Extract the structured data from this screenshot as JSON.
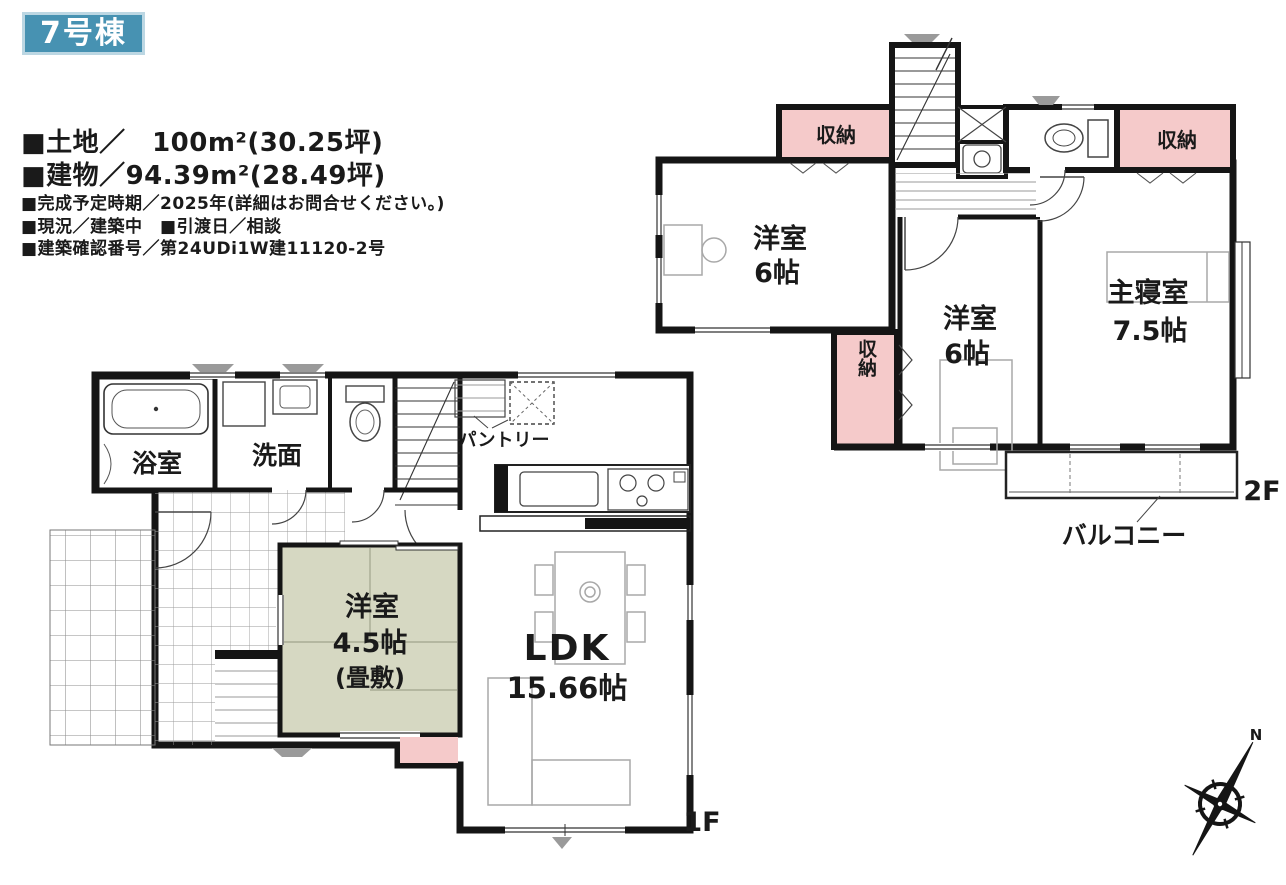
{
  "badge": {
    "label": "7号棟"
  },
  "info": {
    "lines": [
      "■土地／　100m²(30.25坪)",
      "■建物／94.39m²(28.49坪)",
      "■完成予定時期／2025年(詳細はお問合せください。)",
      "■現況／建築中　■引渡日／相談",
      "■建築確認番号／第24UDi1W建11120-2号"
    ]
  },
  "floor1": {
    "floor_label": "1F",
    "bath": "浴室",
    "washroom": "洗面",
    "pantry": "パントリー",
    "tatami_room": [
      "洋室",
      "4.5帖",
      "(畳敷)"
    ],
    "ldk": [
      "LDK",
      "15.66帖"
    ]
  },
  "floor2": {
    "floor_label": "2F",
    "closet_top_left": "収納",
    "closet_top_right": "収納",
    "closet_mid": "収納",
    "west_room_left": [
      "洋室",
      "6帖"
    ],
    "west_room_center": [
      "洋室",
      "6帖"
    ],
    "master_bedroom": [
      "主寝室",
      "7.5帖"
    ],
    "balcony": "バルコニー"
  },
  "compass": {
    "north": "N"
  },
  "colors": {
    "badge_bg": "#4792b2",
    "closet_pink": "#f5caca",
    "tatami_green": "#d6d8c2",
    "wall": "#151515"
  }
}
